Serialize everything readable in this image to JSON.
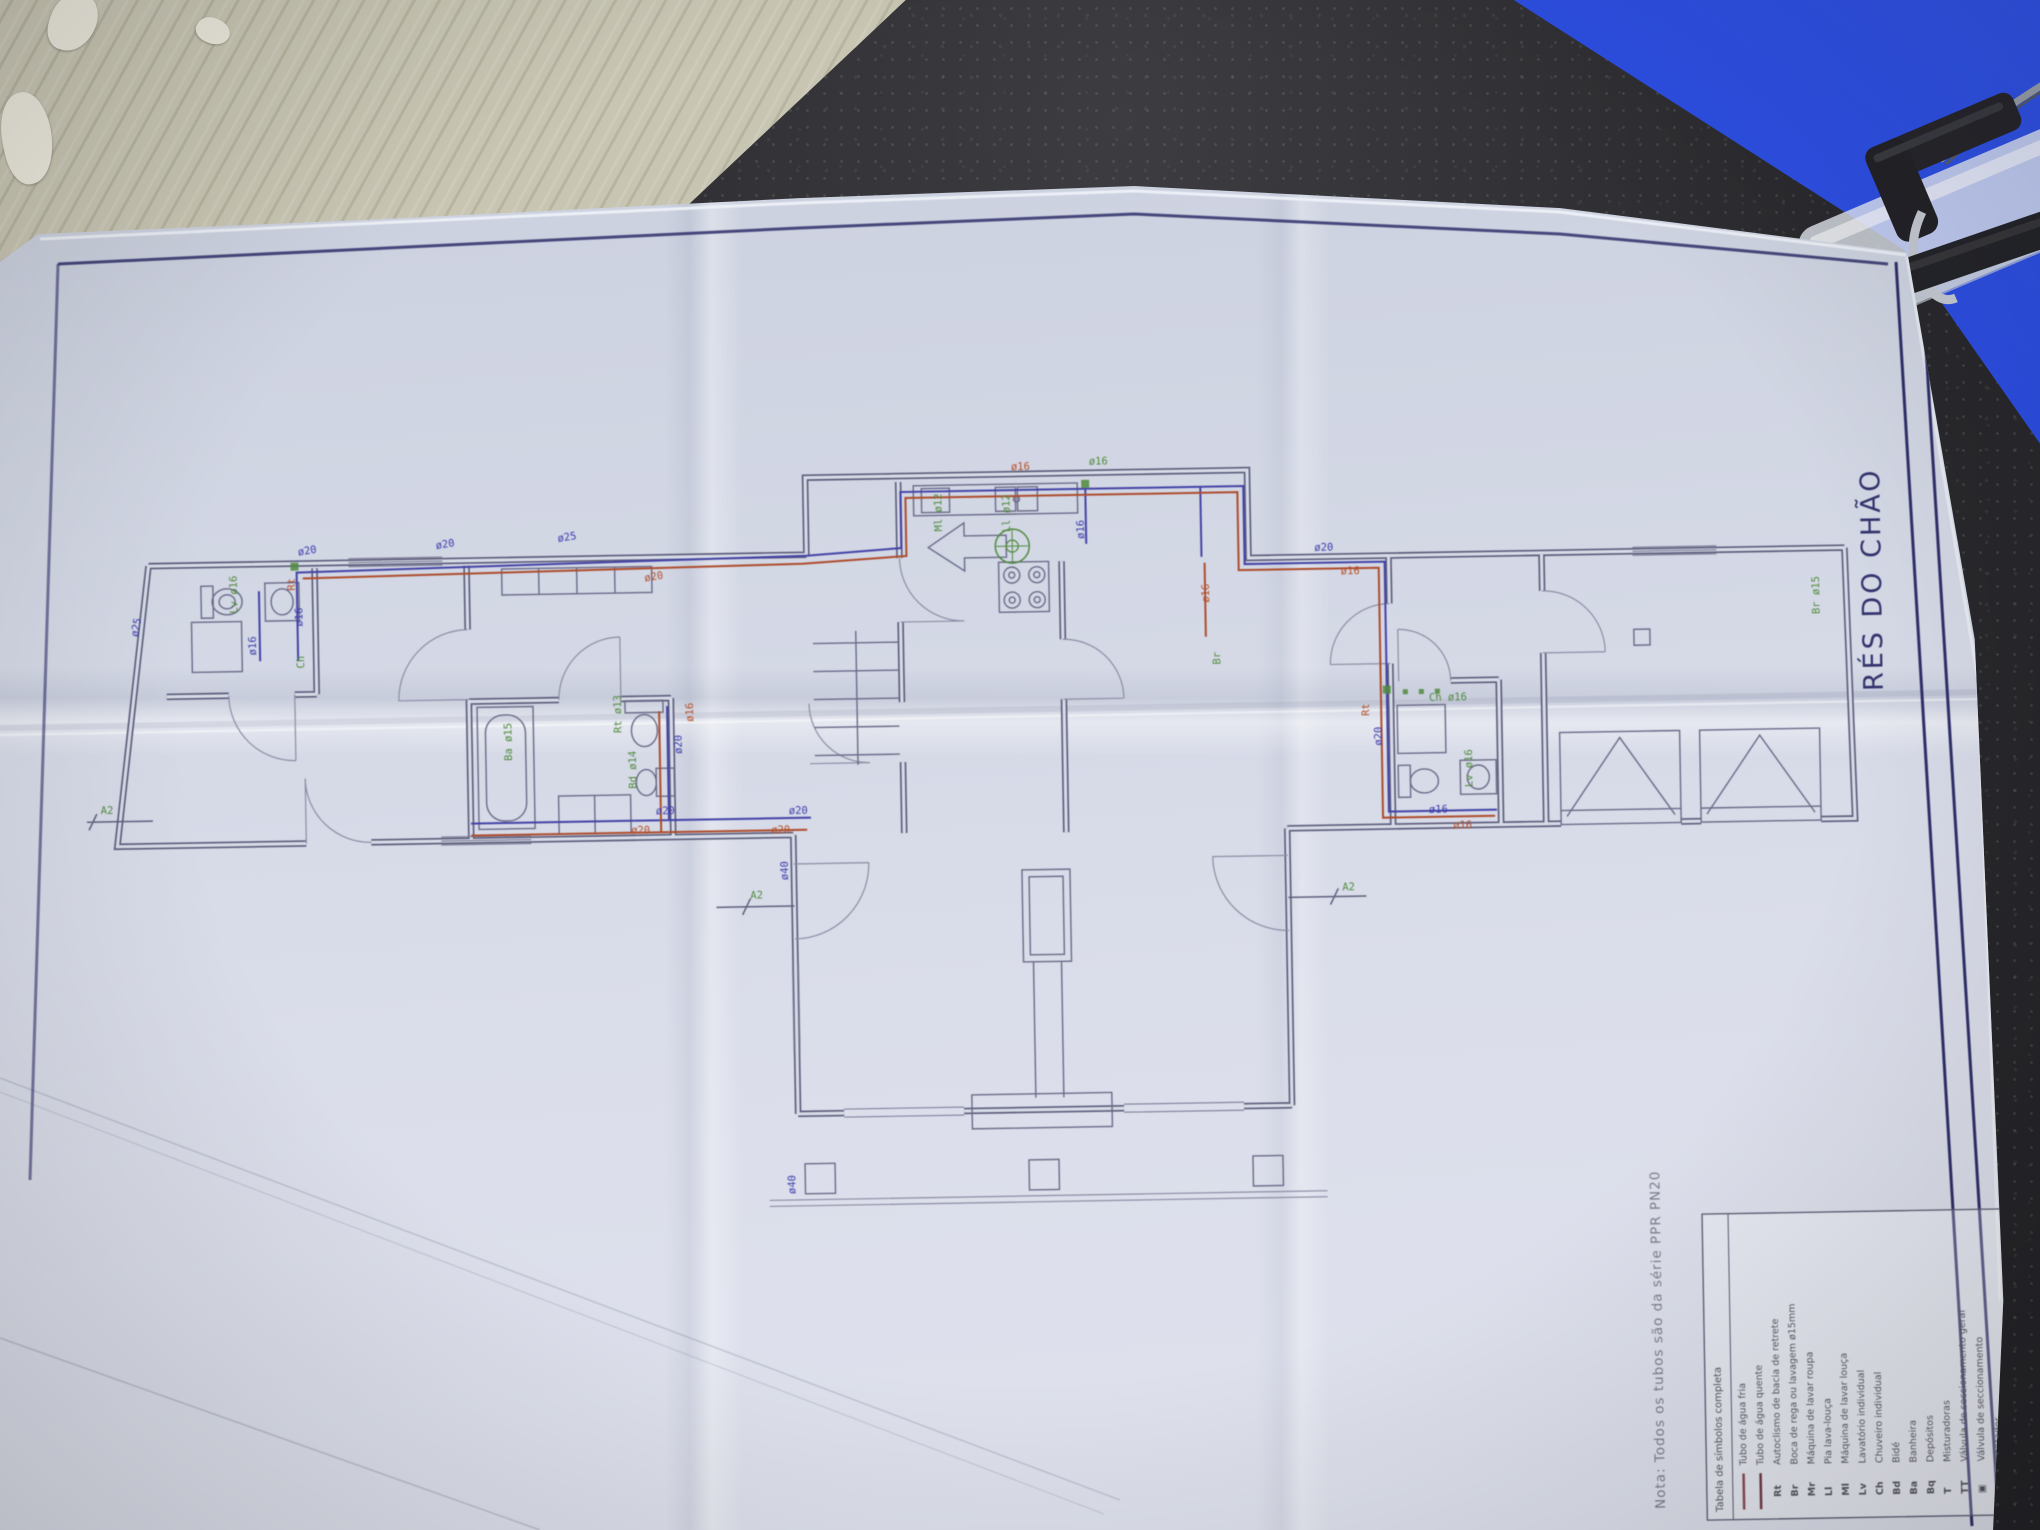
{
  "scene": {
    "description": "Photograph of a folded plumbing floor-plan drawing lying on a dark speckled countertop, with corrugated cardboard at top-left and a blue clipboard at top-right",
    "objects": [
      "countertop",
      "cardboard-sheet",
      "blue-clipboard",
      "clipboard-clip",
      "blueprint-paper"
    ]
  },
  "plan": {
    "title": "RÉS DO CHÃO",
    "pipe_diameters_used": [
      "ø12",
      "ø13",
      "ø14",
      "ø15",
      "ø16",
      "ø20",
      "ø25",
      "ø40"
    ],
    "connection_markers": [
      "A2",
      "A2",
      "A2"
    ],
    "labels": [
      {
        "t": "ø20",
        "x": 302,
        "y": 543,
        "r": -8,
        "c": "blue"
      },
      {
        "t": "ø20",
        "x": 440,
        "y": 539,
        "r": -8,
        "c": "blue"
      },
      {
        "t": "ø25",
        "x": 562,
        "y": 534,
        "r": -8,
        "c": "blue"
      },
      {
        "t": "ø20",
        "x": 648,
        "y": 575,
        "r": -8,
        "c": "red"
      },
      {
        "t": "ø16",
        "x": 258,
        "y": 642,
        "r": -90,
        "c": "blue"
      },
      {
        "t": "ø16",
        "x": 305,
        "y": 614,
        "r": -90,
        "c": "blue"
      },
      {
        "t": "Rt",
        "x": 298,
        "y": 578,
        "r": -90,
        "c": "red"
      },
      {
        "t": "Ch",
        "x": 306,
        "y": 656,
        "r": -90,
        "c": "green"
      },
      {
        "t": "Lv ø16",
        "x": 240,
        "y": 600,
        "r": -90,
        "c": "green"
      },
      {
        "t": "ø25",
        "x": 140,
        "y": 622,
        "r": -78,
        "c": "blue"
      },
      {
        "t": "A2",
        "x": 100,
        "y": 798,
        "r": 0,
        "c": "green"
      },
      {
        "t": "ø20",
        "x": 655,
        "y": 808,
        "r": 0,
        "c": "blue"
      },
      {
        "t": "ø20",
        "x": 630,
        "y": 827,
        "r": 0,
        "c": "red"
      },
      {
        "t": "ø20",
        "x": 788,
        "y": 810,
        "r": 0,
        "c": "blue"
      },
      {
        "t": "ø20",
        "x": 770,
        "y": 829,
        "r": 0,
        "c": "red"
      },
      {
        "t": "Ba ø15",
        "x": 512,
        "y": 752,
        "r": -90,
        "c": "green"
      },
      {
        "t": "Rt ø13",
        "x": 622,
        "y": 726,
        "r": -90,
        "c": "green"
      },
      {
        "t": "Bd ø14",
        "x": 636,
        "y": 782,
        "r": -90,
        "c": "green"
      },
      {
        "t": "ø20",
        "x": 682,
        "y": 748,
        "r": -90,
        "c": "blue"
      },
      {
        "t": "ø16",
        "x": 694,
        "y": 716,
        "r": -90,
        "c": "red"
      },
      {
        "t": "ø16",
        "x": 1016,
        "y": 470,
        "r": 0,
        "c": "red"
      },
      {
        "t": "ø16",
        "x": 1094,
        "y": 466,
        "r": 0,
        "c": "green"
      },
      {
        "t": "ø16",
        "x": 1088,
        "y": 540,
        "r": -90,
        "c": "blue"
      },
      {
        "t": "Ml ø12",
        "x": 946,
        "y": 530,
        "r": -90,
        "c": "green"
      },
      {
        "t": "Ll ø12",
        "x": 1014,
        "y": 532,
        "r": -90,
        "c": "green"
      },
      {
        "t": "ø16",
        "x": 1212,
        "y": 606,
        "r": -90,
        "c": "red"
      },
      {
        "t": "Br",
        "x": 1222,
        "y": 668,
        "r": -90,
        "c": "green"
      },
      {
        "t": "ø40",
        "x": 786,
        "y": 876,
        "r": -90,
        "c": "blue"
      },
      {
        "t": "A2",
        "x": 748,
        "y": 894,
        "r": 0,
        "c": "green"
      },
      {
        "t": "A2",
        "x": 1340,
        "y": 896,
        "r": 0,
        "c": "green"
      },
      {
        "t": "ø40",
        "x": 788,
        "y": 1190,
        "r": -90,
        "c": "blue"
      },
      {
        "t": "ø20",
        "x": 1318,
        "y": 556,
        "r": 0,
        "c": "blue"
      },
      {
        "t": "ø16",
        "x": 1344,
        "y": 580,
        "r": 0,
        "c": "red"
      },
      {
        "t": "ø20",
        "x": 1382,
        "y": 752,
        "r": -90,
        "c": "blue"
      },
      {
        "t": "Rt",
        "x": 1370,
        "y": 722,
        "r": -90,
        "c": "red"
      },
      {
        "t": "Ch ø16",
        "x": 1430,
        "y": 708,
        "r": 0,
        "c": "green"
      },
      {
        "t": "Lv ø16",
        "x": 1472,
        "y": 795,
        "r": -90,
        "c": "green"
      },
      {
        "t": "ø16",
        "x": 1428,
        "y": 820,
        "r": 0,
        "c": "blue"
      },
      {
        "t": "ø16",
        "x": 1452,
        "y": 836,
        "r": 0,
        "c": "red"
      },
      {
        "t": "Br ø15",
        "x": 1822,
        "y": 628,
        "r": -90,
        "c": "green"
      }
    ]
  },
  "legend": {
    "header": "Tabela de símbolos completa",
    "note": "Nota:  Todos os tubos são da série PPR PN20",
    "rows": [
      {
        "sym": "",
        "type": "line",
        "color": "#8c4a55",
        "label": "Tubo de água fria"
      },
      {
        "sym": "",
        "type": "line",
        "color": "#703945",
        "label": "Tubo de água quente"
      },
      {
        "sym": "Rt",
        "type": "code",
        "label": "Autoclismo de bacia de retrete"
      },
      {
        "sym": "Br",
        "type": "code",
        "label": "Boca de rega ou lavagem ø15mm"
      },
      {
        "sym": "Mr",
        "type": "code",
        "label": "Máquina de lavar roupa"
      },
      {
        "sym": "Ll",
        "type": "code",
        "label": "Pia lava-louça"
      },
      {
        "sym": "Ml",
        "type": "code",
        "label": "Máquina de lavar louça"
      },
      {
        "sym": "Lv",
        "type": "code",
        "label": "Lavatório individual"
      },
      {
        "sym": "Ch",
        "type": "code",
        "label": "Chuveiro individual"
      },
      {
        "sym": "Bd",
        "type": "code",
        "label": "Bidé"
      },
      {
        "sym": "Ba",
        "type": "code",
        "label": "Banheira"
      },
      {
        "sym": "Bq",
        "type": "code",
        "label": "Depósitos"
      },
      {
        "sym": "T",
        "type": "code",
        "label": "Misturadoras"
      },
      {
        "sym": "TT",
        "type": "code",
        "label": "Válvula de seccionamento geral"
      },
      {
        "sym": "▣",
        "type": "code",
        "label": "Válvula de seccionamento"
      },
      {
        "sym": "◆",
        "type": "code",
        "label": "Contador"
      },
      {
        "sym": "●",
        "type": "code",
        "label": "Cilindro de termossifão"
      },
      {
        "sym": "◉",
        "type": "code",
        "label": "Esquentador"
      }
    ]
  }
}
